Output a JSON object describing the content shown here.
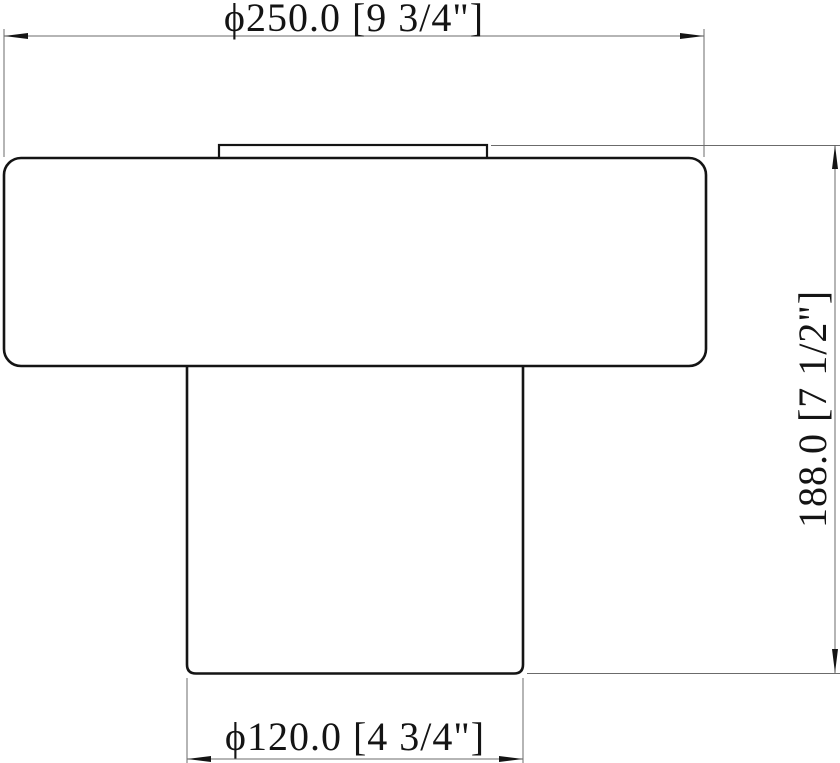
{
  "drawing": {
    "type": "cad-dimension-drawing",
    "view": "front-profile",
    "dimensions": {
      "top_diameter": {
        "label": "ϕ250.0 [9 3/4\"]",
        "mm": "250.0",
        "inches": "9 3/4\""
      },
      "height": {
        "label": "188.0 [7 1/2\"]",
        "mm": "188.0",
        "inches": "7 1/2\""
      },
      "bottom_diameter": {
        "label": "ϕ120.0 [4 3/4\"]",
        "mm": "120.0",
        "inches": "4 3/4\""
      }
    },
    "colors": {
      "outline": "#141414",
      "dimension_lines": "#6b6b6b",
      "text": "#141414",
      "background": "#ffffff"
    }
  }
}
